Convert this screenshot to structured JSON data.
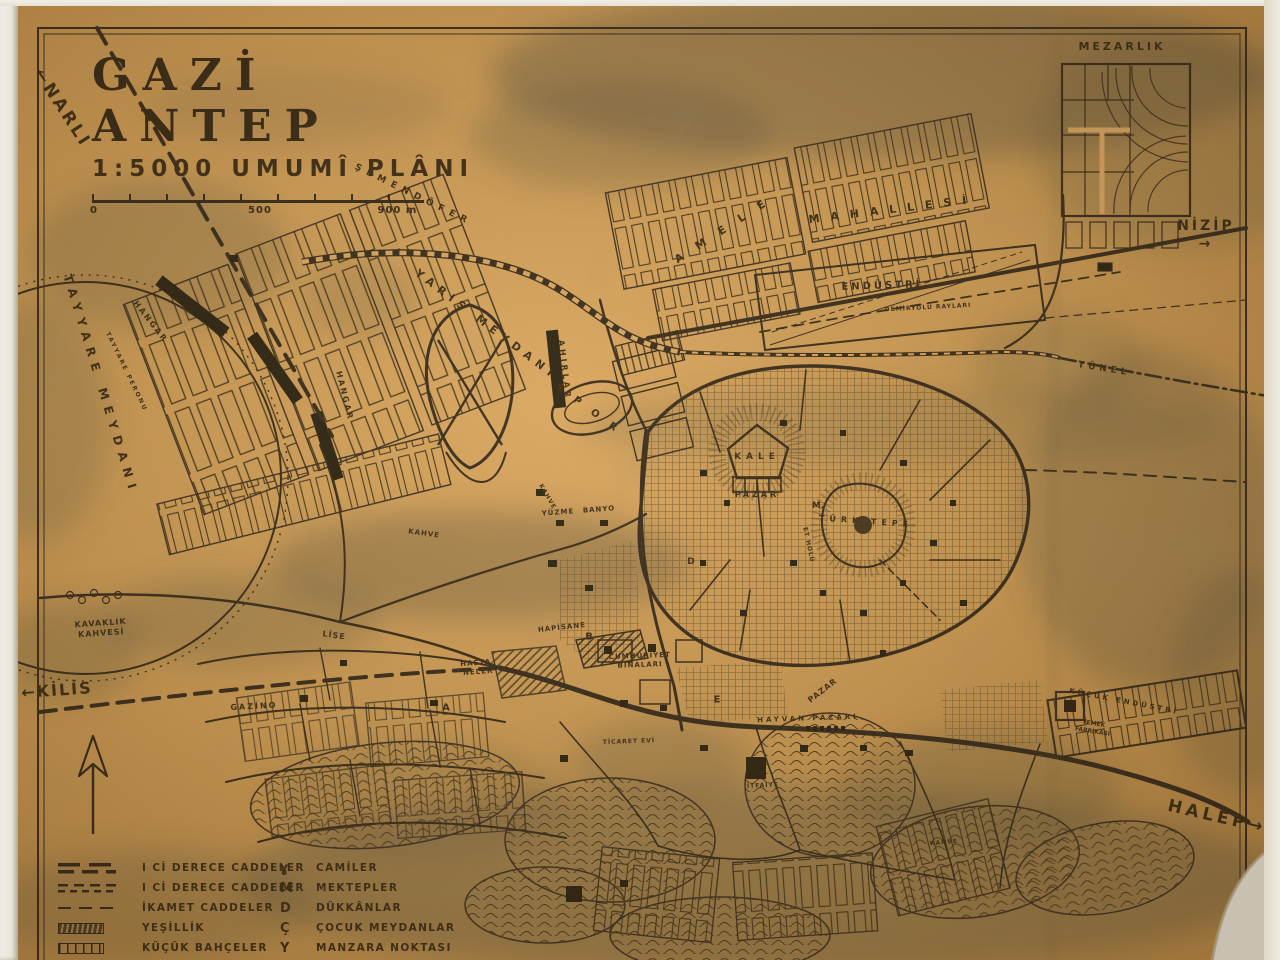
{
  "document": {
    "kind": "scanned hand-drawn city plan",
    "language": "Turkish"
  },
  "title_block": {
    "title": "GAZİ ANTEP",
    "subtitle": "1:5000 UMUMÎ PLÂNI",
    "scale_labels": [
      "0",
      "500",
      "900 m"
    ]
  },
  "colors": {
    "paper": "#cf9a52",
    "ink": "#2b2013",
    "wash": "#5a523c",
    "scan_margin": "#efece3"
  },
  "map": {
    "labels": [
      {
        "id": "narli",
        "text": "←NARLI",
        "x": 62,
        "y": 108,
        "size": 17,
        "rot": 57,
        "ls": 3
      },
      {
        "id": "mezarlik",
        "text": "MEZARLIK",
        "x": 1122,
        "y": 47,
        "size": 11,
        "rot": 0,
        "ls": 3
      },
      {
        "id": "nizip",
        "text": "NİZİP →",
        "x": 1206,
        "y": 235,
        "size": 14,
        "rot": 0,
        "ls": 3
      },
      {
        "id": "tunel",
        "text": "TÜNEL",
        "x": 1104,
        "y": 370,
        "size": 9,
        "rot": 9,
        "ls": 4
      },
      {
        "id": "semendofer",
        "text": "ŞEMENDÖFER",
        "x": 413,
        "y": 196,
        "size": 9,
        "rot": 26,
        "ls": 6
      },
      {
        "id": "amele",
        "text": "AMELE",
        "x": 727,
        "y": 228,
        "size": 11,
        "rot": -33,
        "ls": 16
      },
      {
        "id": "mahallesi",
        "text": "MAHALLESİ",
        "x": 893,
        "y": 210,
        "size": 11,
        "rot": -7,
        "ls": 11
      },
      {
        "id": "endustri",
        "text": "ENDÜSTRİ",
        "x": 882,
        "y": 286,
        "size": 10,
        "rot": -2,
        "ls": 3
      },
      {
        "id": "demiryolu-raylari",
        "text": "DEMİRYOLU RAYLARI",
        "x": 928,
        "y": 308,
        "size": 6,
        "rot": -3,
        "ls": 1
      },
      {
        "id": "yaris-meydani",
        "text": "YARIŞ MEYDANI",
        "x": 486,
        "y": 325,
        "size": 11,
        "rot": 37,
        "ls": 6
      },
      {
        "id": "ahirlar",
        "text": "AHIRLAR",
        "x": 564,
        "y": 370,
        "size": 8,
        "rot": 83,
        "ls": 3
      },
      {
        "id": "spor",
        "text": "SPOR",
        "x": 592,
        "y": 412,
        "size": 10,
        "rot": 36,
        "ls": 14
      },
      {
        "id": "hangar-1",
        "text": "HANGAR",
        "x": 150,
        "y": 322,
        "size": 8,
        "rot": 52,
        "ls": 2
      },
      {
        "id": "hangar-2",
        "text": "HANGAR",
        "x": 344,
        "y": 396,
        "size": 8,
        "rot": 76,
        "ls": 2
      },
      {
        "id": "tayyare-meydani",
        "text": "TAYYARE MEYDANI",
        "x": 100,
        "y": 385,
        "size": 12,
        "rot": 73,
        "ls": 7
      },
      {
        "id": "tayyare-peronu",
        "text": "TAYYARE PERONU",
        "x": 126,
        "y": 372,
        "size": 6,
        "rot": 64,
        "ls": 2
      },
      {
        "id": "kavaklik-kahvesi",
        "text": "KAVAKLIK\nKAHVESİ",
        "x": 101,
        "y": 629,
        "size": 8,
        "rot": -4,
        "ls": 1
      },
      {
        "id": "kilis",
        "text": "←KİLİS",
        "x": 57,
        "y": 691,
        "size": 16,
        "rot": -4,
        "ls": 2
      },
      {
        "id": "gazino",
        "text": "GAZİNO",
        "x": 254,
        "y": 707,
        "size": 8,
        "rot": -3,
        "ls": 2
      },
      {
        "id": "lise",
        "text": "LİSE",
        "x": 334,
        "y": 636,
        "size": 8,
        "rot": 8,
        "ls": 1
      },
      {
        "id": "kahve-1",
        "text": "KAHVE",
        "x": 424,
        "y": 534,
        "size": 7,
        "rot": 8,
        "ls": 1
      },
      {
        "id": "kahve-2",
        "text": "KAHVE",
        "x": 547,
        "y": 497,
        "size": 6,
        "rot": 60,
        "ls": 1
      },
      {
        "id": "yuzme",
        "text": "YÜZME",
        "x": 558,
        "y": 513,
        "size": 7,
        "rot": -4,
        "ls": 1
      },
      {
        "id": "banyo",
        "text": "BANYO",
        "x": 599,
        "y": 510,
        "size": 7,
        "rot": -4,
        "ls": 1
      },
      {
        "id": "kale",
        "text": "KALE",
        "x": 757,
        "y": 458,
        "size": 9,
        "rot": 0,
        "ls": 5
      },
      {
        "id": "pazar-1",
        "text": "PAZAR",
        "x": 757,
        "y": 495,
        "size": 8,
        "rot": 0,
        "ls": 3
      },
      {
        "id": "turk-tepe",
        "text": "TÜRK TEPE",
        "x": 866,
        "y": 522,
        "size": 8,
        "rot": 4,
        "ls": 5
      },
      {
        "id": "et-holu",
        "text": "ET HOLÜ",
        "x": 808,
        "y": 545,
        "size": 6,
        "rot": 78,
        "ls": 1
      },
      {
        "id": "hapisane",
        "text": "HAPİSANE",
        "x": 562,
        "y": 628,
        "size": 7,
        "rot": -6,
        "ls": 1
      },
      {
        "id": "hastaneler",
        "text": "HASTA-\nNELER",
        "x": 478,
        "y": 668,
        "size": 7,
        "rot": -4,
        "ls": 1
      },
      {
        "id": "cumhuriyet-binalari",
        "text": "CUMHURİYET\nBİNALARI",
        "x": 640,
        "y": 661,
        "size": 7,
        "rot": -2,
        "ls": 1
      },
      {
        "id": "pazar-2",
        "text": "PAZAR",
        "x": 823,
        "y": 691,
        "size": 8,
        "rot": -38,
        "ls": 1
      },
      {
        "id": "hayvan-pazari",
        "text": "HAYVAN PAZARI",
        "x": 808,
        "y": 719,
        "size": 7,
        "rot": -2,
        "ls": 3
      },
      {
        "id": "ticaret-evi",
        "text": "TİCARET EVİ",
        "x": 629,
        "y": 742,
        "size": 6,
        "rot": -2,
        "ls": 1
      },
      {
        "id": "itfaiye",
        "text": "İTFAİYE",
        "x": 763,
        "y": 786,
        "size": 6,
        "rot": -3,
        "ls": 1
      },
      {
        "id": "kahve-3",
        "text": "KAHVE",
        "x": 944,
        "y": 843,
        "size": 6,
        "rot": -5,
        "ls": 1
      },
      {
        "id": "kucuk-endustri",
        "text": "KÜÇÜK ENDÜSTRİ",
        "x": 1124,
        "y": 702,
        "size": 7,
        "rot": 11,
        "ls": 3
      },
      {
        "id": "yemek-fabrikasi",
        "text": "YEMEK\nFABRİKASI",
        "x": 1093,
        "y": 728,
        "size": 6,
        "rot": 9,
        "ls": 0
      },
      {
        "id": "halep",
        "text": "HALEP→",
        "x": 1217,
        "y": 817,
        "size": 17,
        "rot": 13,
        "ls": 4
      },
      {
        "id": "zone-a",
        "text": "A",
        "x": 446,
        "y": 708,
        "size": 10,
        "rot": 0,
        "ls": 0
      },
      {
        "id": "zone-b",
        "text": "B",
        "x": 589,
        "y": 637,
        "size": 10,
        "rot": 0,
        "ls": 0
      },
      {
        "id": "zone-d",
        "text": "D",
        "x": 691,
        "y": 563,
        "size": 9,
        "rot": 0,
        "ls": 0
      },
      {
        "id": "zone-e",
        "text": "E",
        "x": 717,
        "y": 700,
        "size": 10,
        "rot": 0,
        "ls": 0
      },
      {
        "id": "zone-m",
        "text": "M.",
        "x": 818,
        "y": 507,
        "size": 9,
        "rot": 0,
        "ls": 0
      }
    ]
  },
  "legend": {
    "columns": [
      {
        "items": [
          {
            "type": "road-primary",
            "symbol_name": "primary-road-symbol",
            "label": "I Cİ DERECE CADDELER"
          },
          {
            "type": "road-secondary",
            "symbol_name": "secondary-road-symbol",
            "label": "I Cİ DERECE CADDELER"
          },
          {
            "type": "road-residential",
            "symbol_name": "residential-road-symbol",
            "label": "İKAMET CADDELER"
          },
          {
            "type": "greenery",
            "symbol_name": "greenery-symbol",
            "label": "YEŞİLLİK"
          },
          {
            "type": "gardens",
            "symbol_name": "small-gardens-symbol",
            "label": "KÜÇÜK BAHÇELER"
          }
        ]
      },
      {
        "items": [
          {
            "type": "glyph",
            "glyph": "ɣ",
            "symbol_name": "mosque-symbol",
            "label": "CAMİLER"
          },
          {
            "type": "glyph",
            "glyph": "M",
            "symbol_name": "school-symbol",
            "label": "MEKTEPLER"
          },
          {
            "type": "glyph",
            "glyph": "D",
            "symbol_name": "shop-symbol",
            "label": "DÜKKÂNLAR"
          },
          {
            "type": "glyph",
            "glyph": "Ç",
            "symbol_name": "playground-symbol",
            "label": "ÇOCUK MEYDANLAR"
          },
          {
            "type": "glyph",
            "glyph": "Y",
            "symbol_name": "viewpoint-symbol",
            "label": "MANZARA NOKTASI"
          }
        ]
      }
    ]
  }
}
